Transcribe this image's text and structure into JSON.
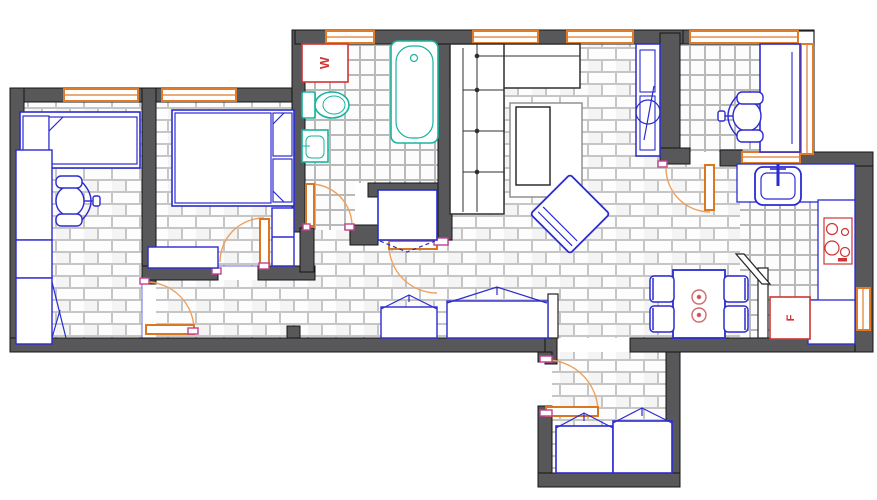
{
  "document": {
    "type": "apartment-floor-plan",
    "style": "top-down CAD drawing",
    "floor_textures": [
      "brick-tile",
      "square-tile"
    ]
  },
  "labels": {
    "washing_machine": "W",
    "refrigerator": "F"
  },
  "colors": {
    "wall": "#58585a",
    "wall_outline": "#141414",
    "furniture_blue": "#2b2bd0",
    "fixture_teal": "#18b59e",
    "window_door_orange": "#e8883c",
    "appliance_red": "#cf3535",
    "door_jamb_pink": "#c2408f",
    "sofa_gray": "#2f2f2f",
    "tile_line": "#c6c6c6",
    "floor": "#ffffff"
  },
  "rooms": [
    {
      "name": "bedroom-1",
      "floor": "brick-tile",
      "furniture": [
        "single-bed",
        "shelving-units",
        "office-chair",
        "wardrobe-with-open-door"
      ]
    },
    {
      "name": "bedroom-2",
      "floor": "brick-tile",
      "furniture": [
        "double-bed",
        "two-pillows",
        "side-cabinet",
        "dresser"
      ]
    },
    {
      "name": "bathroom",
      "floor": "square-tile",
      "furniture": [
        "washing-machine",
        "toilet",
        "wash-basin",
        "bathtub"
      ]
    },
    {
      "name": "hallway",
      "floor": "brick-tile",
      "furniture": [
        "storage-closet",
        "low-wardrobe",
        "wide-wardrobe"
      ]
    },
    {
      "name": "living-room",
      "floor": "brick-tile",
      "furniture": [
        "corner-sofa",
        "coffee-table",
        "rotated-armchair",
        "tv-cabinet"
      ]
    },
    {
      "name": "dining-area",
      "floor": "brick-tile",
      "furniture": [
        "dining-table",
        "four-chairs",
        "two-plates"
      ]
    },
    {
      "name": "kitchen",
      "floor": "square-tile",
      "furniture": [
        "counter-with-sink",
        "right-counter",
        "cooktop-4-burners",
        "refrigerator"
      ]
    },
    {
      "name": "balcony-office",
      "floor": "square-tile",
      "furniture": [
        "desk",
        "office-chair"
      ]
    },
    {
      "name": "entrance-hall",
      "floor": "brick-tile",
      "furniture": [
        "entry-door",
        "two-shoe-wardrobes"
      ]
    }
  ],
  "openings": {
    "window_count": 9,
    "doors": [
      "entry",
      "bedroom-1",
      "bedroom-2",
      "bathroom",
      "hall-closet",
      "balcony"
    ]
  }
}
